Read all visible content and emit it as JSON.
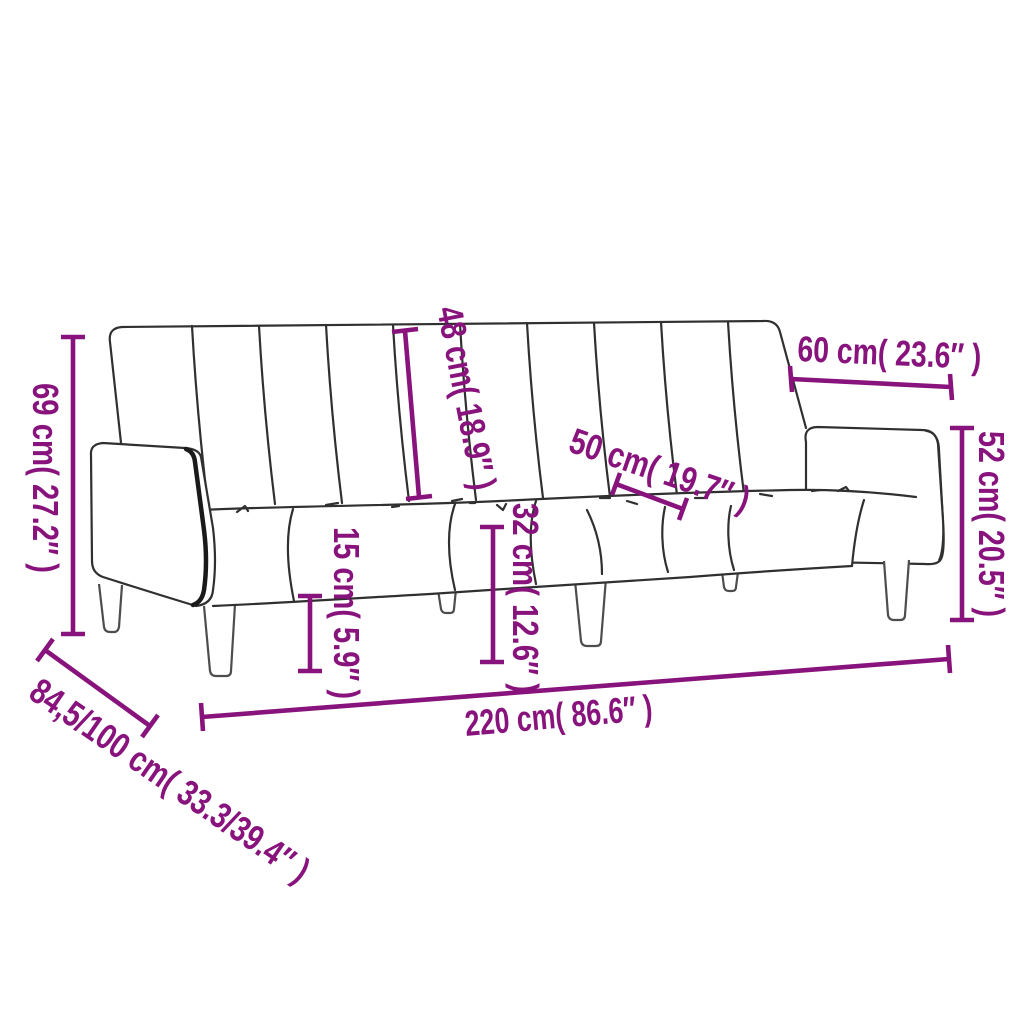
{
  "diagram": {
    "kind": "product-dimension-diagram",
    "subject": "sofa-bed-line-drawing",
    "background_color": "#ffffff",
    "accent_color": "#88137C",
    "outline_color": "#303030",
    "leg_line_color": "#4D4D4D",
    "band_color": "#1A1A1A",
    "dimensions": {
      "overall_height": {
        "label": "69 cm( 27.2″ )"
      },
      "backrest_height": {
        "label": "48 cm( 18.9″ )"
      },
      "armrest_length": {
        "label": "60 cm( 23.6″ )"
      },
      "seat_depth": {
        "label": "50 cm( 19.7″ )"
      },
      "armrest_height": {
        "label": "52 cm( 20.5″ )"
      },
      "clearance_height": {
        "label": "15 cm( 5.9″ )"
      },
      "seat_height": {
        "label": "32 cm( 12.6″ )"
      },
      "overall_width": {
        "label": "220 cm( 86.6″ )"
      },
      "overall_depth": {
        "label": "84,5/100 cm( 33.3/39.4″ )"
      }
    }
  }
}
